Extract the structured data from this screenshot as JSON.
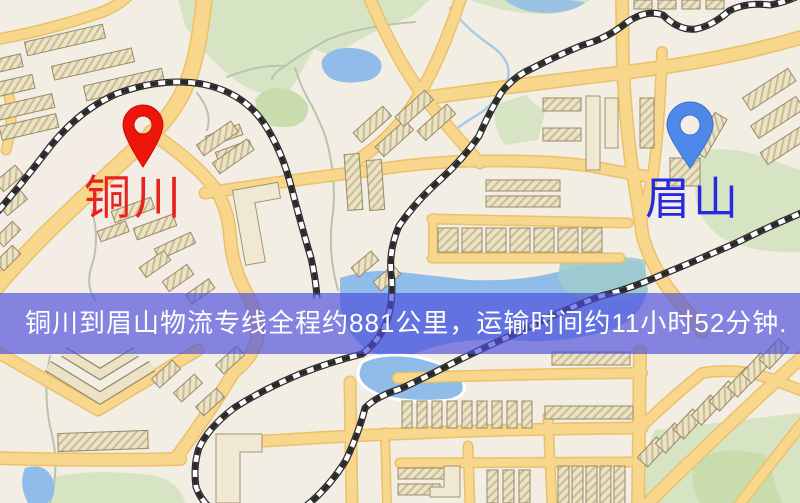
{
  "map": {
    "origin": {
      "name": "铜川",
      "pin_icon": "red-location-pin"
    },
    "destination": {
      "name": "眉山",
      "pin_icon": "blue-location-pin"
    },
    "banner": {
      "text": "铜川到眉山物流专线全程约881公里，运输时间约11小时52分钟.",
      "distance": "881公里",
      "duration": "11小时52分钟"
    },
    "colors": {
      "origin_label_color": "#e8221c",
      "origin_pin_color": "#ee150b",
      "destination_label_color": "#2629e0",
      "destination_pin_color": "#4e89ea",
      "banner_bg": "rgba(74,78,222,0.66)",
      "banner_text_color": "#ffffff",
      "map_background": "#f3eee3",
      "road_color": "#f8d78c",
      "road_casing_color": "#ebc06a",
      "park_color": "#d7e4c4",
      "water_color": "#8fbce8",
      "railway_color": "#2a2a2a"
    }
  }
}
